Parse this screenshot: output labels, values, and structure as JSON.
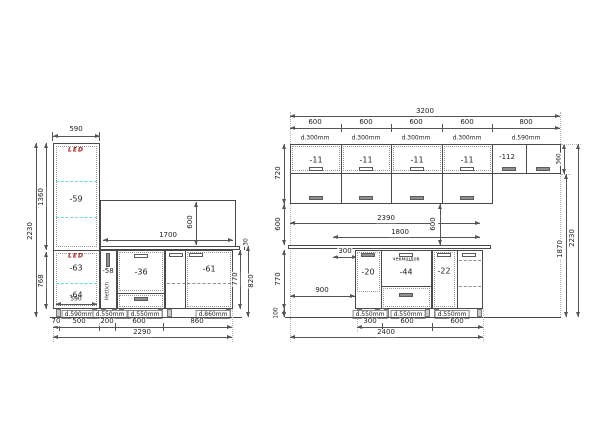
{
  "left": {
    "top_width": "590",
    "total_height": "2230",
    "upper_height": "1360",
    "lower_height": "768",
    "led": "LED",
    "tall_upper": "-59",
    "tall_lower_top": "-63",
    "tall_lower_bottom": "-64",
    "tall_inner_width": "590",
    "panel_width": "1700",
    "panel_height": "600",
    "counter_thickness": "30",
    "base1": "-58",
    "base1_note": "Hettich",
    "base2": "-36",
    "base3": "-61",
    "base_height": "770",
    "base_height_total": "820",
    "plinth_labels": [
      "d.590mm",
      "d.550mm",
      "d.550mm",
      "d.860mm"
    ],
    "bottom_dims": [
      "70",
      "500",
      "200",
      "600",
      "860"
    ],
    "total_width": "2290"
  },
  "right": {
    "total_top": "3200",
    "segments": [
      "600",
      "600",
      "600",
      "600",
      "800"
    ],
    "depths": [
      "d.300mm",
      "d.300mm",
      "d.300mm",
      "d.300mm",
      "d.590mm"
    ],
    "wall_cabs": [
      "-11",
      "-11",
      "-11",
      "-11"
    ],
    "fridge_cab": "-112",
    "fridge_h": "360",
    "wall_h": "720",
    "gap_h": "600",
    "base_h": "770",
    "plinth_h": "100",
    "counter_len": "2390",
    "rail_len": "1800",
    "gap_dim": "600",
    "offset": "300",
    "open_span": "900",
    "base1": "-20",
    "base2": "-44",
    "base2_note": "чекмщдов",
    "base3": "-22",
    "to_top": "1870",
    "total_h": "2230",
    "plinth_labels": [
      "d.550mm",
      "d.550mm",
      "d.550mm"
    ],
    "bottom_dims": [
      "300",
      "600",
      "600"
    ],
    "total_bottom": "2400"
  }
}
